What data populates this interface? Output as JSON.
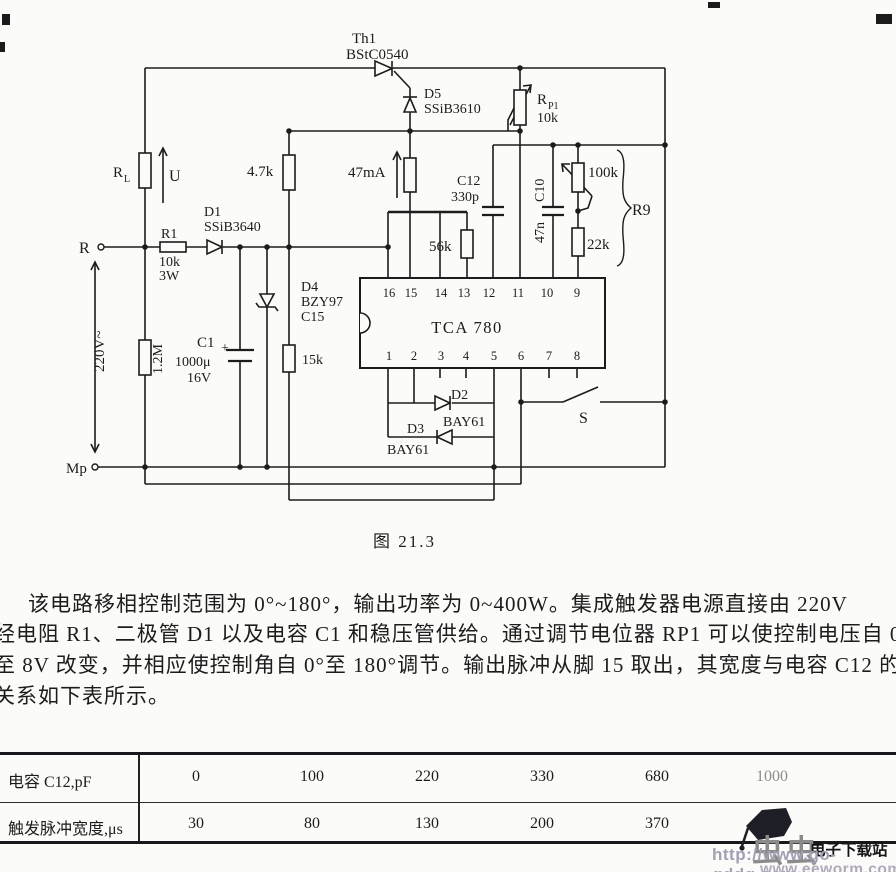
{
  "page": {
    "caption": "图 21.3"
  },
  "circuit": {
    "thyristor": {
      "name": "Th1",
      "part": "BStC0540"
    },
    "d5": {
      "name": "D5",
      "part": "SSiB3610"
    },
    "rp1": {
      "name": "R",
      "sub": "P1",
      "value": "10k"
    },
    "rl": {
      "name": "R",
      "sub": "L"
    },
    "u": "U",
    "terminal_r": "R",
    "terminal_mp": "Mp",
    "r1": {
      "name": "R1",
      "value": "10k",
      "power": "3W"
    },
    "d1": {
      "name": "D1",
      "part": "SSiB3640"
    },
    "r_4k7": "4.7k",
    "current": "47mA",
    "c12": {
      "name": "C12",
      "value": "330p"
    },
    "c10": {
      "name": "C10",
      "value": "47n"
    },
    "r_100k": "100k",
    "r_22k": "22k",
    "r9": "R9",
    "r_56k": "56k",
    "ic": {
      "name": "TCA 780",
      "pins_top": [
        "16",
        "15",
        "14",
        "13",
        "12",
        "11",
        "10",
        "9"
      ],
      "pins_bottom": [
        "1",
        "2",
        "3",
        "4",
        "5",
        "6",
        "7",
        "8"
      ]
    },
    "d4": {
      "name": "D4",
      "part": "BZY97",
      "type": "C15"
    },
    "r_15k": "15k",
    "c1": {
      "name": "C1",
      "plus": "+",
      "value": "1000μ",
      "voltage": "16V"
    },
    "r_1m2": "1.2M",
    "mains": "220V~",
    "s": "S",
    "d2": {
      "name": "D2",
      "part": "BAY61"
    },
    "d3": {
      "name": "D3",
      "part": "BAY61"
    }
  },
  "paragraph": {
    "lines": [
      "该电路移相控制范围为 0°~180°，输出功率为 0~400W。集成触发器电源直接由 220V",
      "经电阻 R1、二极管 D1 以及电容 C1 和稳压管供给。通过调节电位器 RP1 可以使控制电压自 0",
      "至 8V 改变，并相应使控制角自 0°至 180°调节。输出脉冲从脚 15 取出，其宽度与电容 C12 的",
      "关系如下表所示。"
    ]
  },
  "table": {
    "rows": [
      {
        "label": "电容 C12,pF",
        "values": [
          "0",
          "100",
          "220",
          "330",
          "680",
          "1000"
        ]
      },
      {
        "label": "触发脉冲宽度,μs",
        "values": [
          "30",
          "80",
          "130",
          "200",
          "370",
          ""
        ]
      }
    ]
  },
  "watermark": {
    "brand": "虫虫",
    "site": "电子下载站",
    "url1": "http://www.go-gddq.com",
    "url2": "www.eeworm.com"
  },
  "chart_data": {
    "type": "table",
    "categories_label": "电容 C12,pF",
    "values_label": "触发脉冲宽度,μs",
    "categories": [
      0,
      100,
      220,
      330,
      680,
      1000
    ],
    "values": [
      30,
      80,
      130,
      200,
      370,
      null
    ]
  }
}
